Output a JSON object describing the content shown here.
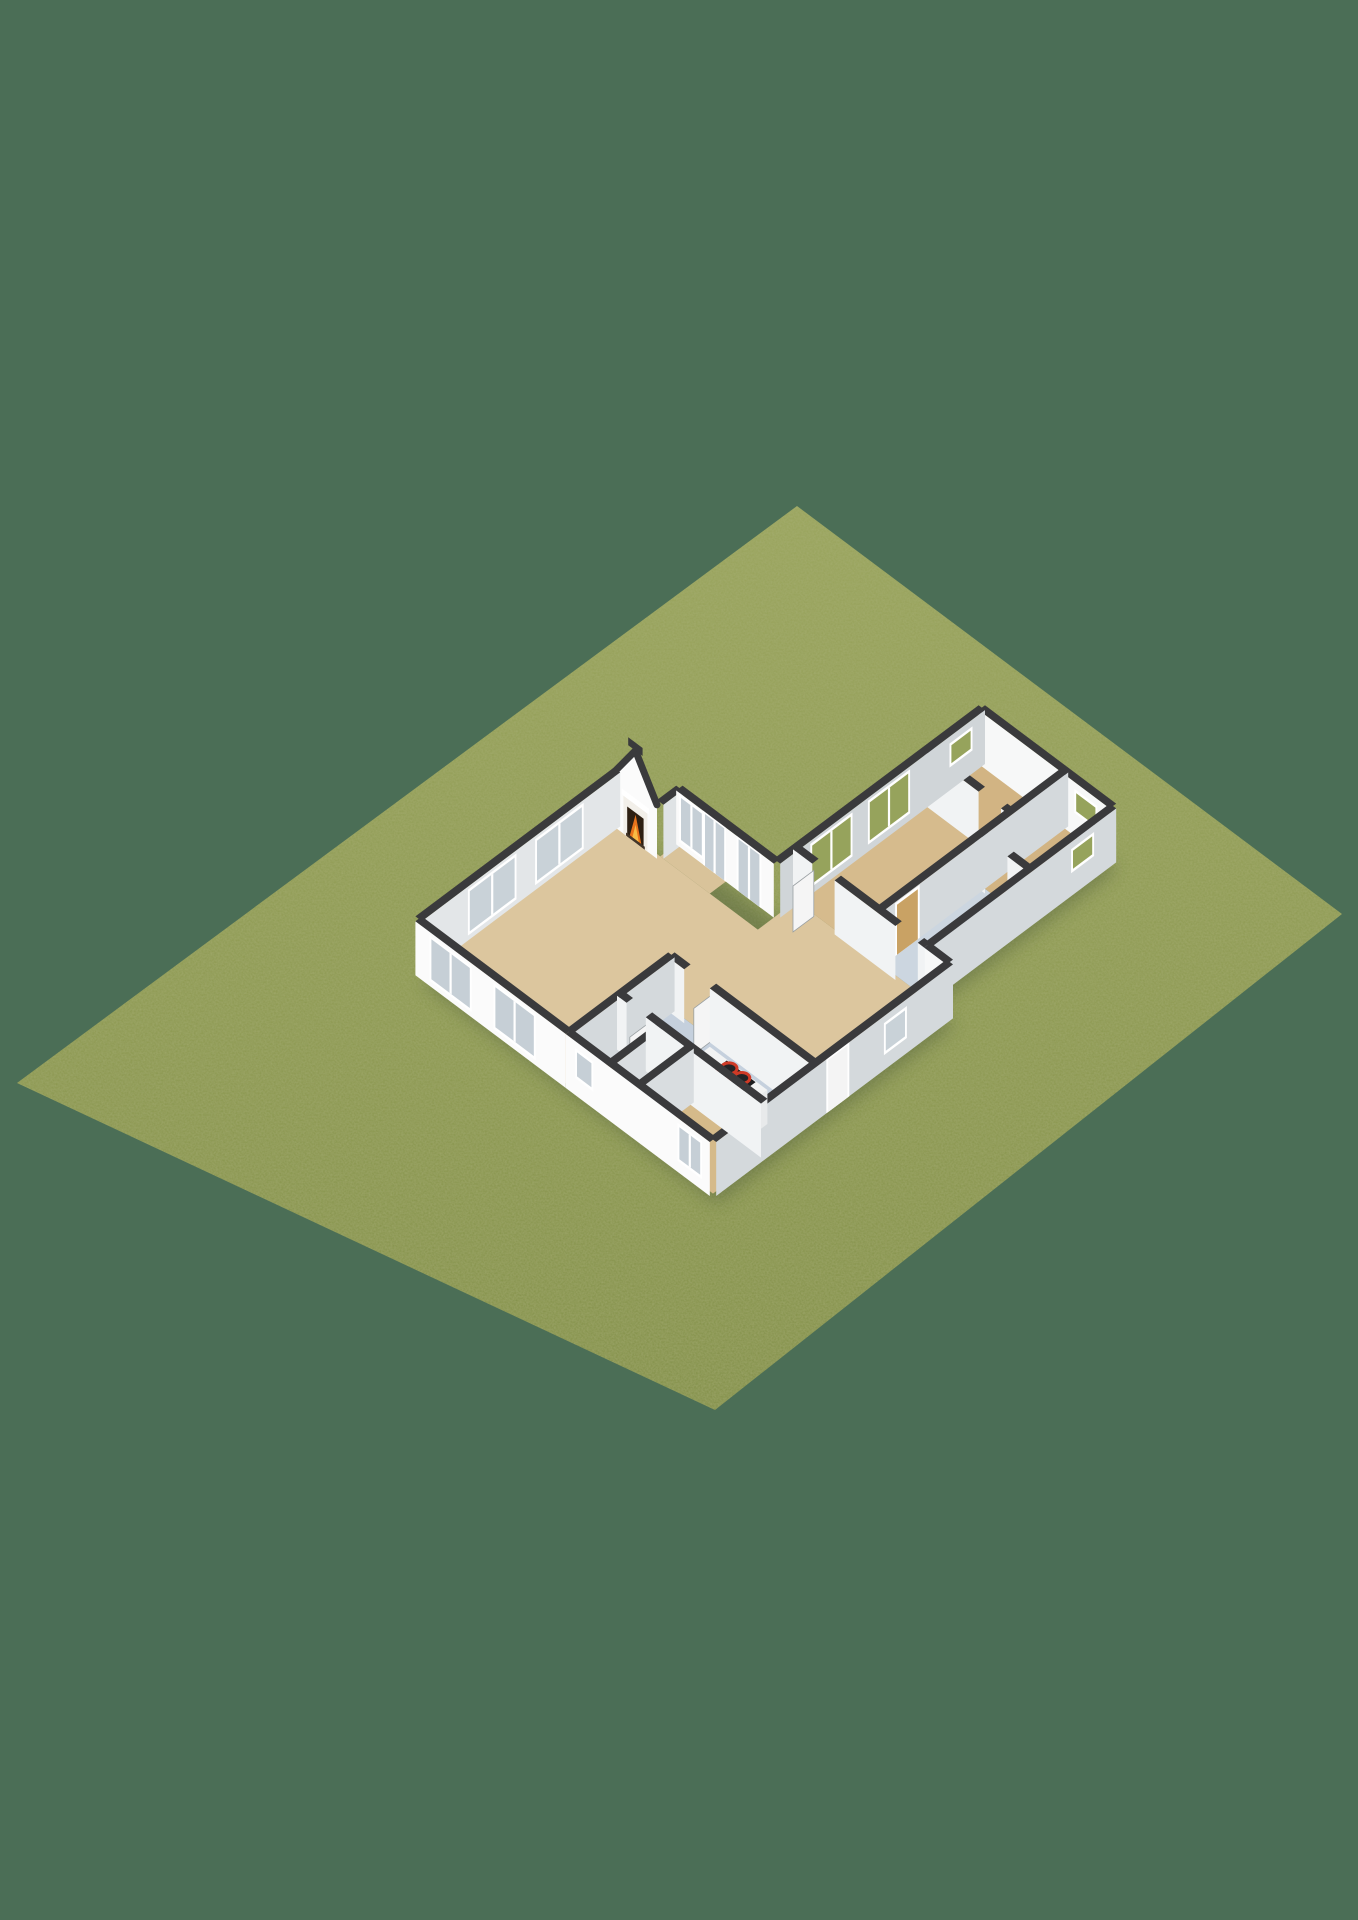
{
  "meta": {
    "view_label": "3d-floorplan-render"
  },
  "scene": {
    "width": 1358,
    "height": 1920,
    "background": "#4b6e56",
    "projection": {
      "origin": [
        617,
        824
      ],
      "kx": 32,
      "ky": 24
    },
    "wall_height": 54,
    "wall_t": 0.2,
    "colors": {
      "wall_cap": "#3a3a3c",
      "shadow": "#2f3d2b",
      "lawn_top": "#99a45c",
      "lawn_mid": "#8e9a52",
      "lawn_bot": "#839049"
    },
    "glass": {
      "sky": "#c6cfd6",
      "pale": "#c9d2d8",
      "green": "#96a35c",
      "wood": "#c9a264",
      "panel": "#f4f4f4"
    },
    "lawn_points": [
      [
        797,
        506
      ],
      [
        1342,
        914
      ],
      [
        715,
        1410
      ],
      [
        17,
        1083
      ]
    ],
    "shadow_hull": [
      [
        0,
        0
      ],
      [
        1.35,
        0
      ],
      [
        1.35,
        -0.6
      ],
      [
        4.4,
        -0.6
      ],
      [
        4.4,
        -7
      ],
      [
        8.5,
        -7
      ],
      [
        8.5,
        -1.2
      ],
      [
        9.2,
        -1.2
      ],
      [
        9.2,
        6.2
      ],
      [
        0,
        6.2
      ]
    ],
    "floors": [
      {
        "name": "living",
        "x0": 0,
        "y0": 0,
        "x1": 4.7,
        "y1": 6.2,
        "color": "#dcc69e"
      },
      {
        "name": "entry-bay",
        "x0": 1.35,
        "y0": -0.6,
        "x1": 2.9,
        "y1": 0,
        "color": "#d9c39a"
      },
      {
        "name": "hall",
        "x0": 4.4,
        "y0": -1.2,
        "x1": 9.2,
        "y1": 3.0,
        "color": "#dcc69e"
      },
      {
        "name": "kitchen",
        "x0": 4.7,
        "y0": 3.0,
        "x1": 9.2,
        "y1": 4.6,
        "color": "#c5d0dd"
      },
      {
        "name": "wc",
        "x0": 4.7,
        "y0": 4.6,
        "x1": 6.0,
        "y1": 6.2,
        "color": "#d6b173"
      },
      {
        "name": "closet",
        "x0": 6.0,
        "y0": 4.6,
        "x1": 6.9,
        "y1": 6.2,
        "color": "#ebebe9"
      },
      {
        "name": "bedroom2",
        "x0": 6.9,
        "y0": 4.6,
        "x1": 9.2,
        "y1": 6.2,
        "color": "#d5ba8a"
      },
      {
        "name": "master",
        "x0": 4.4,
        "y0": -5.3,
        "x1": 7.0,
        "y1": -1.2,
        "color": "#d6bb8d"
      },
      {
        "name": "small1",
        "x0": 4.4,
        "y0": -7.0,
        "x1": 7.0,
        "y1": -5.3,
        "color": "#d2b483"
      },
      {
        "name": "small2",
        "x0": 7.0,
        "y0": -7.0,
        "x1": 8.5,
        "y1": -4.4,
        "color": "#d2b483"
      },
      {
        "name": "bathroom",
        "x0": 7.0,
        "y0": -4.4,
        "x1": 8.5,
        "y1": -1.2,
        "color": "#ccd6e0"
      }
    ],
    "walls": [
      {
        "n": "front",
        "o": "a",
        "y": -0.6,
        "x0": 1.35,
        "x1": 4.4,
        "face": "#fafafa",
        "win": [
          {
            "u0": 0.15,
            "u1": 0.8,
            "z0": 8,
            "z1": 50,
            "g": "sky",
            "m": 1
          },
          {
            "u0": 0.9,
            "u1": 1.5,
            "z0": 0,
            "z1": 52,
            "g": "sky",
            "m": 1
          },
          {
            "u0": 1.95,
            "u1": 2.6,
            "z0": 0,
            "z1": 52,
            "g": "sky",
            "m": 1
          }
        ]
      },
      {
        "n": "wing-ne",
        "o": "a",
        "y": -7,
        "x0": 4.4,
        "x1": 8.5,
        "face": "#f7f8f8",
        "win": [
          {
            "u0": 3.05,
            "u1": 3.65,
            "z0": 26,
            "z1": 44,
            "g": "green"
          }
        ]
      },
      {
        "n": "hall-ne",
        "o": "a",
        "y": -1.2,
        "x0": 8.5,
        "x1": 9.2,
        "face": "#f7f8f8"
      },
      {
        "n": "south",
        "o": "a",
        "y": 6.2,
        "x0": 4.7,
        "x1": 9.2,
        "face": "#fbfbfb",
        "win": [
          {
            "u0": 0.35,
            "u1": 0.8,
            "z0": 20,
            "z1": 44,
            "g": "sky"
          },
          {
            "u0": 3.55,
            "u1": 4.2,
            "z0": 14,
            "z1": 46,
            "g": "sky",
            "m": 1
          }
        ]
      },
      {
        "n": "living-sw",
        "o": "a",
        "y": 6.2,
        "x0": 0,
        "x1": 4.7,
        "face": "#fbfbfb",
        "win": [
          {
            "u0": 0.5,
            "u1": 1.7,
            "z0": 8,
            "z1": 48,
            "g": "sky",
            "m": 1
          },
          {
            "u0": 2.5,
            "u1": 3.7,
            "z0": 8,
            "z1": 48,
            "g": "sky",
            "m": 1
          }
        ]
      },
      {
        "n": "spine-1",
        "o": "a",
        "y": -1.2,
        "x0": 4.4,
        "x1": 5.0,
        "face": "#f1f3f4"
      },
      {
        "n": "spine-2",
        "o": "a",
        "y": -1.2,
        "x0": 5.7,
        "x1": 7.6,
        "face": "#f1f3f4"
      },
      {
        "n": "spine-3",
        "o": "a",
        "y": -1.2,
        "x0": 8.3,
        "x1": 8.5,
        "face": "#f1f3f4"
      },
      {
        "n": "hall-kitchen-1",
        "o": "a",
        "y": 3.0,
        "x0": 4.7,
        "x1": 5.2,
        "face": "#f1f3f4"
      },
      {
        "n": "hall-kitchen-2",
        "o": "a",
        "y": 3.0,
        "x0": 6.0,
        "x1": 9.2,
        "face": "#f1f3f4"
      },
      {
        "n": "kitchen-wc-1",
        "o": "a",
        "y": 4.6,
        "x0": 4.7,
        "x1": 5.0,
        "face": "#f1f3f4"
      },
      {
        "n": "kitchen-wc-2",
        "o": "a",
        "y": 4.6,
        "x0": 5.6,
        "x1": 9.2,
        "face": "#f1f3f4"
      },
      {
        "n": "small1-master-a",
        "o": "a",
        "y": -5.3,
        "x0": 4.4,
        "x1": 6.1,
        "face": "#f1f3f4"
      },
      {
        "n": "small1-master-b",
        "o": "a",
        "y": -5.3,
        "x0": 6.8,
        "x1": 7.0,
        "face": "#f1f3f4"
      },
      {
        "n": "small2-bath-a",
        "o": "a",
        "y": -4.4,
        "x0": 7.0,
        "x1": 7.2,
        "face": "#f1f3f4"
      },
      {
        "n": "small2-bath-b",
        "o": "a",
        "y": -4.4,
        "x0": 7.9,
        "x1": 8.5,
        "face": "#f1f3f4"
      },
      {
        "n": "living-nw",
        "o": "b",
        "x": 0,
        "y0": 0,
        "y1": 6.2,
        "face": "#e3e6e8",
        "win": [
          {
            "u0": 1.2,
            "u1": 2.6,
            "z0": 8,
            "z1": 48,
            "g": "pale",
            "m": 1
          },
          {
            "u0": 3.3,
            "u1": 4.7,
            "z0": 8,
            "z1": 48,
            "g": "pale",
            "m": 1
          }
        ]
      },
      {
        "n": "bay-stub",
        "o": "b",
        "x": 1.35,
        "y0": -0.6,
        "y1": 0,
        "face": "#dfe3e5"
      },
      {
        "n": "wing-nw",
        "o": "b",
        "x": 4.4,
        "y0": -7,
        "y1": -0.6,
        "face": "#d0d5d8",
        "win": [
          {
            "u0": 0.45,
            "u1": 1.05,
            "z0": 26,
            "z1": 44,
            "g": "green"
          },
          {
            "u0": 2.4,
            "u1": 3.6,
            "z0": 10,
            "z1": 48,
            "g": "green",
            "m": 1
          },
          {
            "u0": 4.2,
            "u1": 5.4,
            "z0": 10,
            "z1": 48,
            "g": "green",
            "m": 1
          }
        ]
      },
      {
        "n": "east",
        "o": "b",
        "x": 9.2,
        "y0": -1.2,
        "y1": 6.2,
        "face": "#d4d9dc",
        "win": [
          {
            "u0": 1.5,
            "u1": 2.1,
            "z0": 18,
            "z1": 44,
            "g": "pale"
          },
          {
            "u0": 3.3,
            "u1": 3.9,
            "z0": 0,
            "z1": 52,
            "g": "panel"
          }
        ]
      },
      {
        "n": "living-e",
        "o": "b",
        "x": 4.7,
        "y0": 3.0,
        "y1": 6.2,
        "face": "#d4d9dc"
      },
      {
        "n": "wing-e",
        "o": "b",
        "x": 8.5,
        "y0": -7,
        "y1": -1.2,
        "face": "#d4d9dc",
        "win": [
          {
            "u0": 0.75,
            "u1": 1.35,
            "z0": 26,
            "z1": 44,
            "g": "green"
          }
        ]
      },
      {
        "n": "wc-closet",
        "o": "b",
        "x": 6.0,
        "y0": 4.6,
        "y1": 6.2,
        "face": "#d9dde0"
      },
      {
        "n": "closet-bed2",
        "o": "b",
        "x": 6.9,
        "y0": 4.6,
        "y1": 6.2,
        "face": "#d9dde0"
      },
      {
        "n": "wing-mid",
        "o": "b",
        "x": 7.0,
        "y0": -7,
        "y1": -1.2,
        "face": "#d4d9dc",
        "win": [
          {
            "u0": 4.7,
            "u1": 5.35,
            "z0": 0,
            "z1": 50,
            "g": "wood"
          }
        ]
      }
    ],
    "gable": {
      "y": 0,
      "x0": 0,
      "x1": 1.35,
      "peak": 92,
      "face": "#fbfbfb",
      "surround": {
        "x0": 0.3,
        "x1": 1.05,
        "z0": 0,
        "z1": 38,
        "color": "#f2efe9"
      },
      "opening": {
        "x0": 0.42,
        "x1": 0.93,
        "z0": 0,
        "z1": 30,
        "color": "#2e2013"
      },
      "flame": {
        "x0": 0.5,
        "x1": 0.86,
        "z1": 28,
        "z2": 18,
        "outer": "#e8731c",
        "inner": "#f7bb45"
      },
      "mantel": {
        "x0": 0.25,
        "x1": 1.1,
        "z0": 38,
        "z1": 44,
        "color": "#ffffff"
      },
      "hearth": {
        "x0": 0.38,
        "x1": 0.97,
        "z0": 0,
        "z1": 3,
        "color": "#433528"
      },
      "chimney": {
        "x0": 0.45,
        "x1": 0.9,
        "z0": 92,
        "z1": 100
      }
    },
    "counter": {
      "x0": 6.8,
      "y0": 3.9,
      "x1": 8.6,
      "y1": 4.5,
      "h": 34,
      "side": "#e8eaeb",
      "front": "#f6f7f7",
      "top": "#f2f3f3"
    },
    "cooktop": {
      "x0": 7.35,
      "y0": 3.92,
      "x1": 8.25,
      "y1": 4.48,
      "color": "#1d1d1f"
    },
    "burners": [
      [
        7.55,
        4.05
      ],
      [
        7.95,
        4.05
      ],
      [
        7.55,
        4.35
      ],
      [
        7.95,
        4.35
      ]
    ],
    "burner_style": {
      "rx": 8,
      "ry": 5.5,
      "fill": "#232325",
      "ring": "#cf3a26",
      "ring_w": 3
    },
    "toilet": {
      "x0": 5.0,
      "y0": 5.7,
      "x1": 5.4,
      "y1": 6.1,
      "h": 16,
      "side": "#ecedee",
      "front": "#f5f5f5",
      "top": "#ffffff",
      "seat": "#e6e6e6"
    },
    "leaves": [
      {
        "x": 5.0,
        "y0": -1.15,
        "y1": -0.5
      },
      {
        "x": 6.0,
        "y0": 3.05,
        "y1": 3.6
      },
      {
        "x": 5.6,
        "y0": 4.65,
        "y1": 5.2
      }
    ],
    "leaf_style": {
      "fill": "#f5f5f5",
      "edge": "#9aa0a3",
      "h": 46
    }
  }
}
